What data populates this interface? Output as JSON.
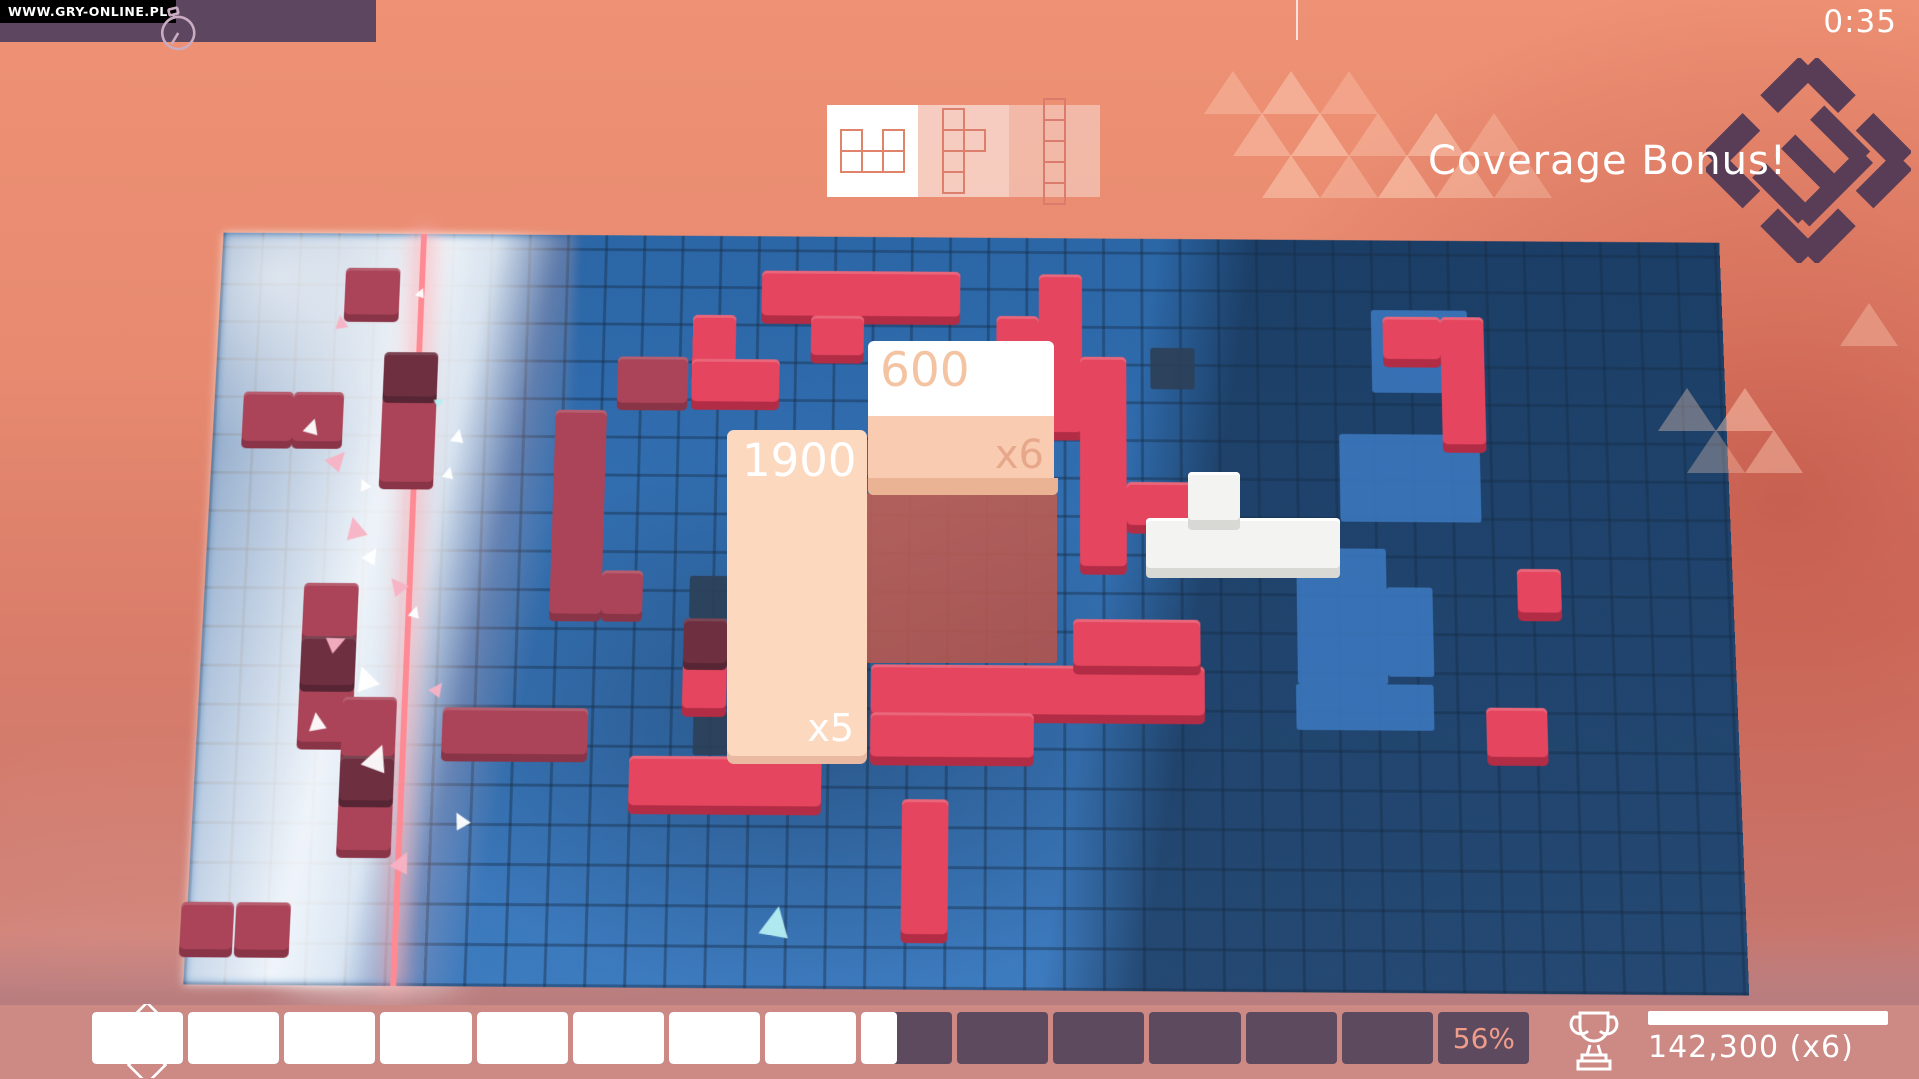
{
  "watermark": "WWW.GRY-ONLINE.PL",
  "hud": {
    "timer": "0:35",
    "banner": "Coverage Bonus!",
    "stopwatch_icon": "stopwatch-icon",
    "logo_icon": "game-diamond-logo"
  },
  "selector": {
    "slots": [
      {
        "name": "u-pentomino",
        "bg": "#ffffff",
        "stroke": "#e0836b",
        "cells": [
          [
            0,
            0
          ],
          [
            2,
            0
          ],
          [
            0,
            1
          ],
          [
            1,
            1
          ],
          [
            2,
            1
          ]
        ]
      },
      {
        "name": "y-pentomino",
        "bg": "rgba(255,255,255,0.55)",
        "stroke": "#dd7f6d",
        "cells": [
          [
            0,
            0
          ],
          [
            0,
            1
          ],
          [
            1,
            1
          ],
          [
            0,
            2
          ],
          [
            0,
            3
          ]
        ]
      },
      {
        "name": "i-pentomino",
        "bg": "rgba(255,255,255,0.38)",
        "stroke": "#d97c6d",
        "cells": [
          [
            0,
            0
          ],
          [
            0,
            1
          ],
          [
            0,
            2
          ],
          [
            0,
            3
          ],
          [
            0,
            4
          ]
        ]
      }
    ]
  },
  "popups": {
    "score_a": {
      "value": "600",
      "mult": "x6"
    },
    "score_b": {
      "value": "1900",
      "mult": "x5"
    }
  },
  "bottom": {
    "percent": 56,
    "percent_label": "56%",
    "segments": 15,
    "score": "142,300  (x6)",
    "bar_fill_color": "#ffffff",
    "bar_empty_color": "#5d4a5e",
    "trophy_icon": "trophy-icon",
    "diamonds_icon": "level-diamonds-icon"
  },
  "colors": {
    "crimson_block": "#e5455e",
    "rose_block": "#ab4459",
    "board_blue": "#3370b2",
    "shadow_navy": "#2c4058",
    "top_bar_purple": "#5d4760",
    "banner_white": "#ffffff",
    "logo_purple": "#593d56"
  },
  "board": {
    "blocks": [
      {
        "x": 565,
        "y": 37,
        "w": 207,
        "h": 48,
        "c": "crimson"
      },
      {
        "x": 617,
        "y": 85,
        "w": 55,
        "h": 42,
        "c": "crimson"
      },
      {
        "x": 854,
        "y": 39,
        "w": 45,
        "h": 168,
        "c": "crimson"
      },
      {
        "x": 810,
        "y": 84,
        "w": 44,
        "h": 43,
        "c": "crimson"
      },
      {
        "x": 1272,
        "y": 82,
        "w": 45,
        "h": 135,
        "c": "crimson"
      },
      {
        "x": 1212,
        "y": 82,
        "w": 60,
        "h": 45,
        "c": "crimson"
      },
      {
        "x": 494,
        "y": 85,
        "w": 45,
        "h": 92,
        "c": "crimson"
      },
      {
        "x": 494,
        "y": 132,
        "w": 91,
        "h": 45,
        "c": "crimson"
      },
      {
        "x": 897,
        "y": 127,
        "w": 48,
        "h": 220,
        "c": "crimson"
      },
      {
        "x": 945,
        "y": 259,
        "w": 80,
        "h": 45,
        "c": "crimson"
      },
      {
        "x": 684,
        "y": 450,
        "w": 340,
        "h": 50,
        "c": "crimson"
      },
      {
        "x": 890,
        "y": 402,
        "w": 130,
        "h": 48,
        "c": "crimson"
      },
      {
        "x": 440,
        "y": 545,
        "w": 195,
        "h": 50,
        "c": "crimson"
      },
      {
        "x": 492,
        "y": 450,
        "w": 45,
        "h": 46,
        "c": "crimson"
      },
      {
        "x": 717,
        "y": 587,
        "w": 47,
        "h": 135,
        "c": "crimson"
      },
      {
        "x": 1345,
        "y": 347,
        "w": 45,
        "h": 45,
        "c": "crimson"
      },
      {
        "x": 1310,
        "y": 490,
        "w": 62,
        "h": 50,
        "c": "crimson"
      },
      {
        "x": 684,
        "y": 499,
        "w": 166,
        "h": 45,
        "c": "crimson"
      },
      {
        "x": 417,
        "y": 130,
        "w": 73,
        "h": 49,
        "c": "rose"
      },
      {
        "x": 354,
        "y": 187,
        "w": 53,
        "h": 213,
        "c": "rose"
      },
      {
        "x": 407,
        "y": 355,
        "w": 42,
        "h": 45,
        "c": "rose"
      },
      {
        "x": 249,
        "y": 497,
        "w": 148,
        "h": 47,
        "c": "rose"
      },
      {
        "x": 130,
        "y": 37,
        "w": 57,
        "h": 50,
        "c": "rose"
      },
      {
        "x": 30,
        "y": 170,
        "w": 52,
        "h": 52,
        "c": "rose"
      },
      {
        "x": 82,
        "y": 170,
        "w": 52,
        "h": 52,
        "c": "rose"
      },
      {
        "x": 174,
        "y": 174,
        "w": 56,
        "h": 90,
        "c": "rose"
      },
      {
        "x": 102,
        "y": 370,
        "w": 56,
        "h": 55,
        "c": "rose"
      },
      {
        "x": 102,
        "y": 475,
        "w": 56,
        "h": 58,
        "c": "rose"
      },
      {
        "x": 147,
        "y": 487,
        "w": 55,
        "h": 60,
        "c": "rose"
      },
      {
        "x": 147,
        "y": 592,
        "w": 55,
        "h": 50,
        "c": "rose"
      },
      {
        "x": -6,
        "y": 695,
        "w": 53,
        "h": 47,
        "c": "rose"
      },
      {
        "x": 49,
        "y": 695,
        "w": 55,
        "h": 47,
        "c": "rose"
      },
      {
        "x": 174,
        "y": 127,
        "w": 56,
        "h": 47,
        "c": "dark"
      },
      {
        "x": 102,
        "y": 425,
        "w": 56,
        "h": 50,
        "c": "dark"
      },
      {
        "x": 147,
        "y": 547,
        "w": 55,
        "h": 45,
        "c": "dark"
      },
      {
        "x": 492,
        "y": 404,
        "w": 45,
        "h": 46,
        "c": "dark"
      }
    ],
    "light_patches": [
      {
        "x": 1200,
        "y": 75,
        "w": 100,
        "h": 88
      },
      {
        "x": 1165,
        "y": 207,
        "w": 145,
        "h": 92
      },
      {
        "x": 1119,
        "y": 327,
        "w": 92,
        "h": 140
      },
      {
        "x": 1211,
        "y": 367,
        "w": 47,
        "h": 92
      },
      {
        "x": 1117,
        "y": 467,
        "w": 140,
        "h": 47
      }
    ],
    "navy_cells": [
      {
        "x": 970,
        "y": 117,
        "w": 46,
        "h": 44
      },
      {
        "x": 500,
        "y": 134,
        "w": 36,
        "h": 43
      },
      {
        "x": 497,
        "y": 360,
        "w": 42,
        "h": 44
      },
      {
        "x": 504,
        "y": 500,
        "w": 36,
        "h": 44
      }
    ],
    "particles": [
      {
        "x": 205,
        "y": 55,
        "s": 10,
        "r": 20,
        "c": "white"
      },
      {
        "x": 120,
        "y": 85,
        "s": 14,
        "r": -10,
        "c": "pink"
      },
      {
        "x": 95,
        "y": 195,
        "s": 16,
        "r": 15,
        "c": "white"
      },
      {
        "x": 122,
        "y": 228,
        "s": 20,
        "r": 40,
        "c": "pink"
      },
      {
        "x": 152,
        "y": 258,
        "s": 12,
        "r": -25,
        "c": "white"
      },
      {
        "x": 230,
        "y": 172,
        "s": 10,
        "r": 60,
        "c": "cyan"
      },
      {
        "x": 247,
        "y": 205,
        "s": 14,
        "r": 10,
        "c": "white"
      },
      {
        "x": 140,
        "y": 298,
        "s": 22,
        "r": -15,
        "c": "pink"
      },
      {
        "x": 163,
        "y": 330,
        "s": 16,
        "r": 30,
        "c": "white"
      },
      {
        "x": 187,
        "y": 360,
        "s": 18,
        "r": -40,
        "c": "pink"
      },
      {
        "x": 211,
        "y": 390,
        "s": 12,
        "r": 15,
        "c": "white"
      },
      {
        "x": 131,
        "y": 420,
        "s": 18,
        "r": 65,
        "c": "pink"
      },
      {
        "x": 156,
        "y": 452,
        "s": 24,
        "r": -20,
        "c": "white"
      },
      {
        "x": 237,
        "y": 468,
        "s": 14,
        "r": 35,
        "c": "pink"
      },
      {
        "x": 112,
        "y": 500,
        "s": 18,
        "r": -10,
        "c": "white"
      },
      {
        "x": 172,
        "y": 532,
        "s": 26,
        "r": 20,
        "c": "white"
      },
      {
        "x": 577,
        "y": 692,
        "s": 30,
        "r": 10,
        "c": "cyan"
      },
      {
        "x": 262,
        "y": 600,
        "s": 16,
        "r": -30,
        "c": "white"
      },
      {
        "x": 205,
        "y": 640,
        "s": 20,
        "r": 25,
        "c": "pink"
      },
      {
        "x": 240,
        "y": 245,
        "s": 12,
        "r": 12,
        "c": "white"
      }
    ]
  },
  "deco_triangles": [
    {
      "x": 1204,
      "y": 68,
      "s": 58,
      "o": 0.35
    },
    {
      "x": 1262,
      "y": 68,
      "s": 58,
      "o": 0.45
    },
    {
      "x": 1320,
      "y": 68,
      "s": 58,
      "o": 0.3
    },
    {
      "x": 1233,
      "y": 110,
      "s": 58,
      "o": 0.4
    },
    {
      "x": 1291,
      "y": 110,
      "s": 58,
      "o": 0.5
    },
    {
      "x": 1349,
      "y": 110,
      "s": 58,
      "o": 0.35
    },
    {
      "x": 1407,
      "y": 110,
      "s": 58,
      "o": 0.45
    },
    {
      "x": 1465,
      "y": 110,
      "s": 58,
      "o": 0.3
    },
    {
      "x": 1262,
      "y": 152,
      "s": 58,
      "o": 0.45
    },
    {
      "x": 1320,
      "y": 152,
      "s": 58,
      "o": 0.35
    },
    {
      "x": 1378,
      "y": 152,
      "s": 58,
      "o": 0.5
    },
    {
      "x": 1436,
      "y": 152,
      "s": 58,
      "o": 0.4
    },
    {
      "x": 1494,
      "y": 152,
      "s": 58,
      "o": 0.3
    },
    {
      "x": 1658,
      "y": 385,
      "s": 58,
      "o": 0.35
    },
    {
      "x": 1716,
      "y": 385,
      "s": 58,
      "o": 0.45
    },
    {
      "x": 1687,
      "y": 427,
      "s": 58,
      "o": 0.3
    },
    {
      "x": 1840,
      "y": 300,
      "s": 58,
      "o": 0.35
    },
    {
      "x": 1745,
      "y": 427,
      "s": 58,
      "o": 0.4
    }
  ],
  "white_piece": {
    "parts": [
      {
        "x": 1146,
        "y": 518,
        "w": 194,
        "h": 50
      },
      {
        "x": 1188,
        "y": 472,
        "w": 52,
        "h": 48
      }
    ]
  }
}
